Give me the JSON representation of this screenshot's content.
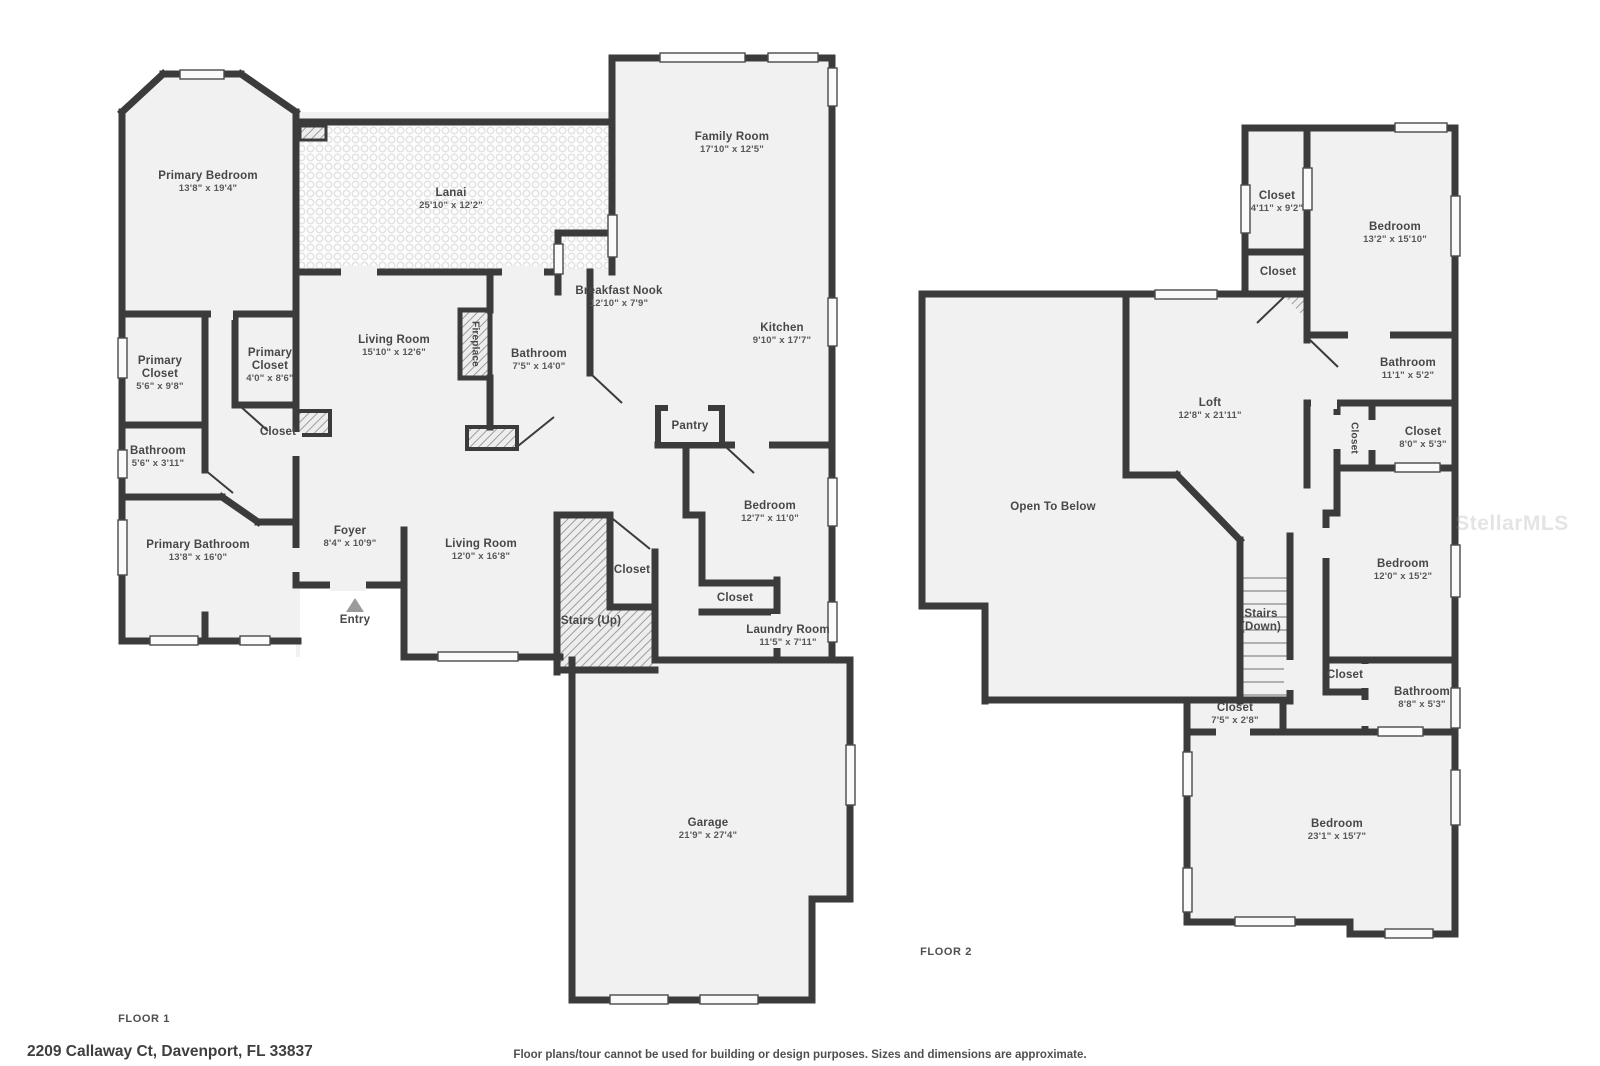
{
  "meta": {
    "floor1_label": "FLOOR 1",
    "floor2_label": "FLOOR 2",
    "address": "2209 Callaway Ct, Davenport, FL 33837",
    "disclaimer": "Floor plans/tour cannot be used for building or design purposes. Sizes and dimensions are approximate.",
    "watermark": "StellarMLS"
  },
  "colors": {
    "wall": "#3b3b3b",
    "floor_fill": "#f1f1f1",
    "label_text": "#474747",
    "window_fill": "#fafafa",
    "entry_marker": "#9a9a9a"
  },
  "floors": [
    {
      "id": "floor-1",
      "label": "FLOOR 1",
      "rooms": [
        {
          "id": "primary-bedroom",
          "name": "Primary Bedroom",
          "dims": "13'8\" x 19'4\"",
          "x": 208,
          "y": 170
        },
        {
          "id": "lanai",
          "name": "Lanai",
          "dims": "25'10\" x 12'2\"",
          "x": 451,
          "y": 187
        },
        {
          "id": "family-room",
          "name": "Family Room",
          "dims": "17'10\" x 12'5\"",
          "x": 732,
          "y": 131
        },
        {
          "id": "breakfast-nook",
          "name": "Breakfast Nook",
          "dims": "12'10\" x 7'9\"",
          "x": 619,
          "y": 285
        },
        {
          "id": "kitchen",
          "name": "Kitchen",
          "dims": "9'10\" x 17'7\"",
          "x": 782,
          "y": 322
        },
        {
          "id": "living-room",
          "name": "Living Room",
          "dims": "15'10\" x 12'6\"",
          "x": 394,
          "y": 334
        },
        {
          "id": "fireplace",
          "name": "Fireplace",
          "dims": "",
          "x": 475,
          "y": 344,
          "vertical": true
        },
        {
          "id": "bathroom-1",
          "name": "Bathroom",
          "dims": "7'5\" x 14'0\"",
          "x": 539,
          "y": 348
        },
        {
          "id": "primary-closet-1",
          "name": "Primary\nCloset",
          "dims": "5'6\" x 9'8\"",
          "x": 160,
          "y": 355
        },
        {
          "id": "primary-closet-2",
          "name": "Primary\nCloset",
          "dims": "4'0\" x 8'6\"",
          "x": 270,
          "y": 347
        },
        {
          "id": "closet-hall",
          "name": "Closet",
          "dims": "",
          "x": 278,
          "y": 426
        },
        {
          "id": "bathroom-2",
          "name": "Bathroom",
          "dims": "5'6\" x 3'11\"",
          "x": 158,
          "y": 445
        },
        {
          "id": "primary-bathroom",
          "name": "Primary Bathroom",
          "dims": "13'8\" x 16'0\"",
          "x": 198,
          "y": 539
        },
        {
          "id": "foyer",
          "name": "Foyer",
          "dims": "8'4\" x 10'9\"",
          "x": 350,
          "y": 525
        },
        {
          "id": "entry",
          "name": "Entry",
          "dims": "",
          "x": 355,
          "y": 614
        },
        {
          "id": "living-room-2",
          "name": "Living Room",
          "dims": "12'0\" x 16'8\"",
          "x": 481,
          "y": 538
        },
        {
          "id": "closet-stairs",
          "name": "Closet",
          "dims": "",
          "x": 632,
          "y": 564
        },
        {
          "id": "stairs-up",
          "name": "Stairs (Up)",
          "dims": "",
          "x": 591,
          "y": 615
        },
        {
          "id": "pantry",
          "name": "Pantry",
          "dims": "",
          "x": 690,
          "y": 420
        },
        {
          "id": "bedroom",
          "name": "Bedroom",
          "dims": "12'7\" x 11'0\"",
          "x": 770,
          "y": 500
        },
        {
          "id": "closet-bedroom",
          "name": "Closet",
          "dims": "",
          "x": 735,
          "y": 592
        },
        {
          "id": "laundry-room",
          "name": "Laundry Room",
          "dims": "11'5\" x 7'11\"",
          "x": 788,
          "y": 624
        },
        {
          "id": "garage",
          "name": "Garage",
          "dims": "21'9\" x 27'4\"",
          "x": 708,
          "y": 817
        }
      ]
    },
    {
      "id": "floor-2",
      "label": "FLOOR 2",
      "rooms": [
        {
          "id": "closet-f2-1",
          "name": "Closet",
          "dims": "4'11\" x 9'2\"",
          "x": 1277,
          "y": 190
        },
        {
          "id": "closet-f2-2",
          "name": "Closet",
          "dims": "",
          "x": 1278,
          "y": 266
        },
        {
          "id": "bedroom-f2-1",
          "name": "Bedroom",
          "dims": "13'2\" x 15'10\"",
          "x": 1395,
          "y": 221
        },
        {
          "id": "bathroom-f2-1",
          "name": "Bathroom",
          "dims": "11'1\" x 5'2\"",
          "x": 1408,
          "y": 357
        },
        {
          "id": "closet-f2-3",
          "name": "Closet",
          "dims": "",
          "x": 1354,
          "y": 438,
          "vertical": true
        },
        {
          "id": "closet-f2-4",
          "name": "Closet",
          "dims": "8'0\" x 5'3\"",
          "x": 1423,
          "y": 426
        },
        {
          "id": "loft",
          "name": "Loft",
          "dims": "12'8\" x 21'11\"",
          "x": 1210,
          "y": 397
        },
        {
          "id": "open-to-below",
          "name": "Open To Below",
          "dims": "",
          "x": 1053,
          "y": 501
        },
        {
          "id": "stairs-down",
          "name": "Stairs\n(Down)",
          "dims": "",
          "x": 1261,
          "y": 608
        },
        {
          "id": "bedroom-f2-2",
          "name": "Bedroom",
          "dims": "12'0\" x 15'2\"",
          "x": 1403,
          "y": 558
        },
        {
          "id": "closet-f2-5",
          "name": "Closet",
          "dims": "",
          "x": 1345,
          "y": 669
        },
        {
          "id": "bathroom-f2-2",
          "name": "Bathroom",
          "dims": "8'8\" x 5'3\"",
          "x": 1422,
          "y": 686
        },
        {
          "id": "closet-f2-6",
          "name": "Closet",
          "dims": "7'5\" x 2'8\"",
          "x": 1235,
          "y": 702
        },
        {
          "id": "bedroom-f2-3",
          "name": "Bedroom",
          "dims": "23'1\" x 15'7\"",
          "x": 1337,
          "y": 818
        }
      ]
    }
  ]
}
